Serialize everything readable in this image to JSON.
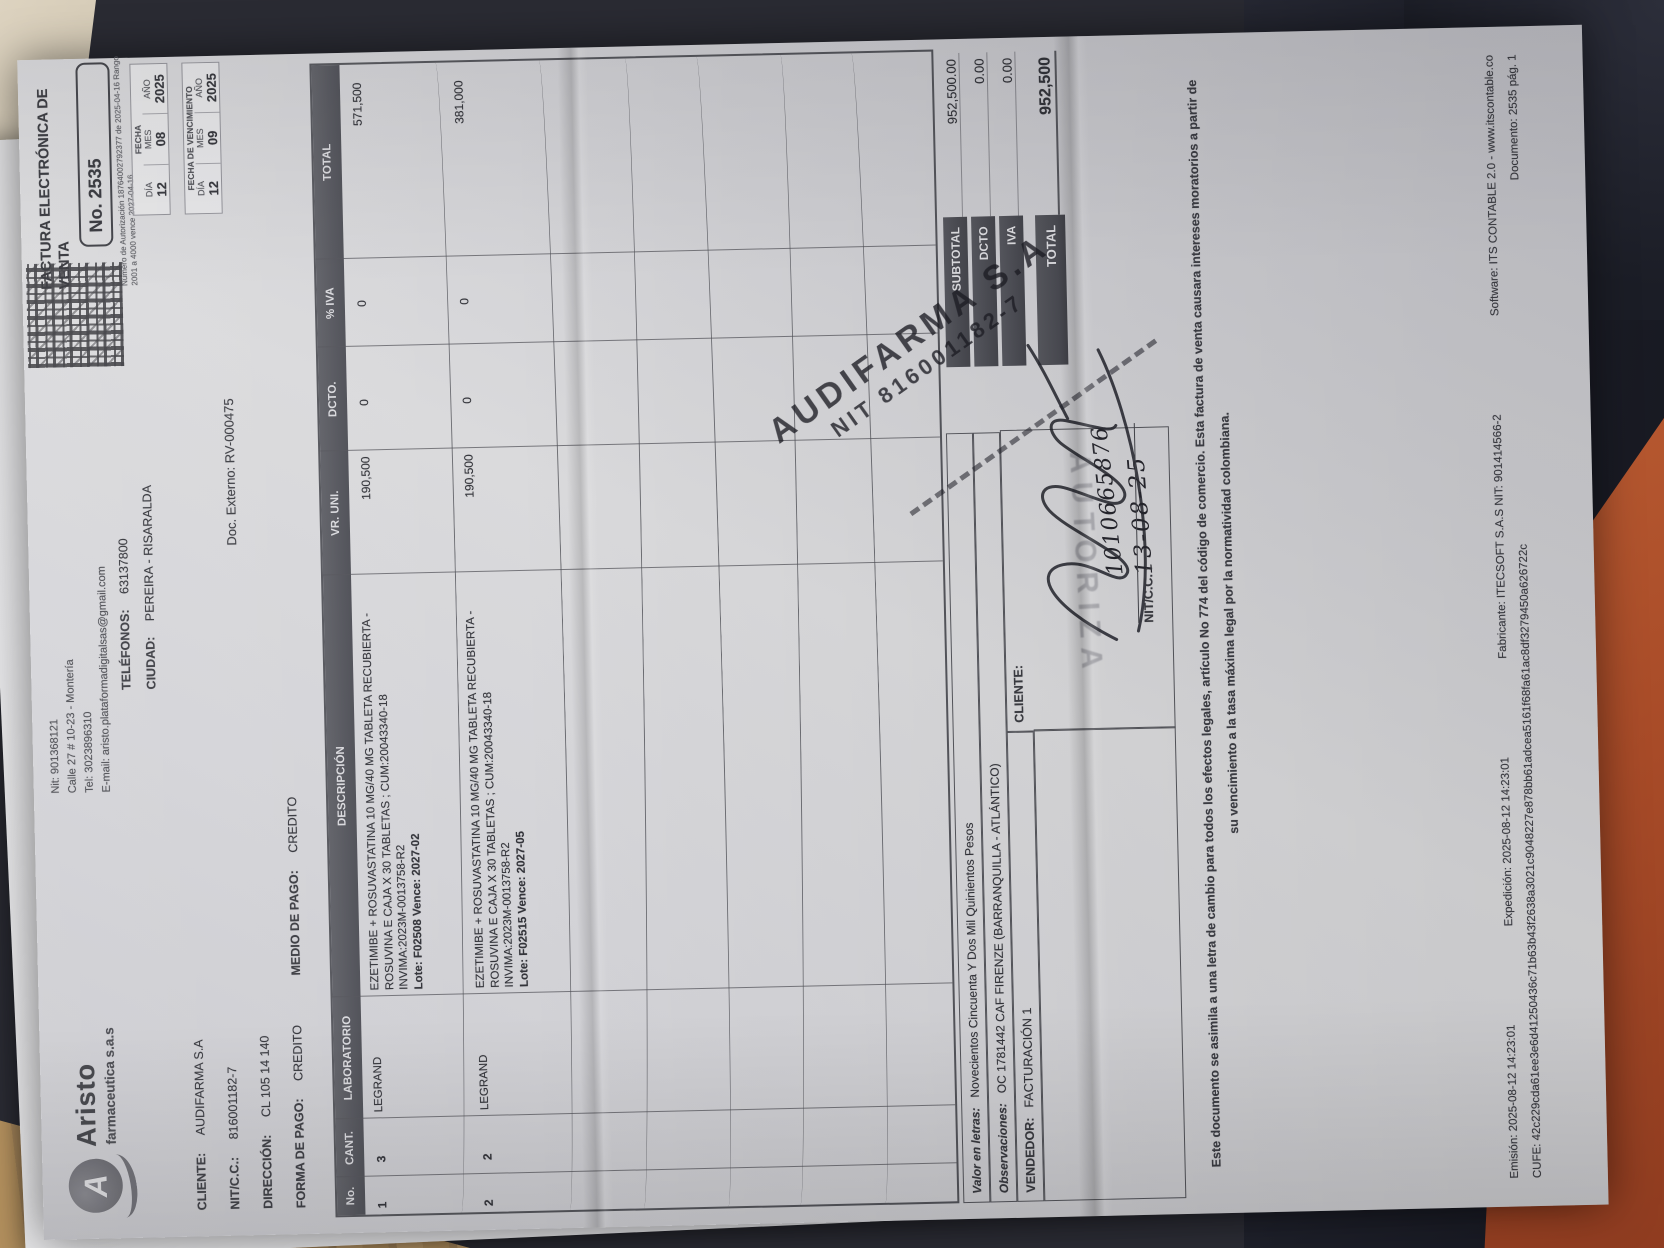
{
  "brand": {
    "logo_letter": "A",
    "name": "Aristo",
    "subname": "farmaceutica s.a.s"
  },
  "supplier": {
    "lines": [
      "Nit: 901368121",
      "Calle 27 # 10-23 - Montería",
      "Tel: 3023896310",
      "E-mail: aristo.plataformadigitalsas@gmail.com"
    ]
  },
  "header": {
    "doc_type": "FACTURA ELECTRÓNICA DE VENTA",
    "number": "No. 2535",
    "auth_line1": "Número de Autorización 18764002792377 de",
    "auth_line2": "2025-04-16 Rango 2001 a 4000 vence 2027-04-16",
    "doc_externo": "Doc. Externo: RV-000475"
  },
  "client": {
    "cliente_label": "CLIENTE:",
    "cliente": "AUDIFARMA S.A",
    "nit_label": "NIT/C.C.:",
    "nit": "816001182-7",
    "direccion_label": "DIRECCIÓN:",
    "direccion": "CL 105 14 140",
    "forma_label": "FORMA DE PAGO:",
    "forma": "CREDITO",
    "medio_label": "MEDIO DE PAGO:",
    "medio": "CREDITO",
    "tel_label": "TELÉFONOS:",
    "tel": "63137800",
    "ciudad_label": "CIUDAD:",
    "ciudad": "PEREIRA - RISARALDA"
  },
  "dates": {
    "fecha_title": "FECHA",
    "venc_title": "FECHA DE VENCIMIENTO",
    "dia_label": "DÍA",
    "mes_label": "MES",
    "ano_label": "AÑO",
    "fecha": {
      "dia": "12",
      "mes": "08",
      "ano": "2025"
    },
    "venc": {
      "dia": "12",
      "mes": "09",
      "ano": "2025"
    }
  },
  "table": {
    "headers": {
      "no": "No.",
      "cant": "CANT.",
      "lab": "LABORATORIO",
      "desc": "DESCRIPCIÓN",
      "vruni": "VR. UNI.",
      "dcto": "DCTO.",
      "iva": "% IVA",
      "total": "TOTAL"
    },
    "items": [
      {
        "no": "1",
        "cant": "3",
        "lab": "LEGRAND",
        "desc1": "EZETIMIBE + ROSUVASTATINA 10 MG/40 MG TABLETA RECUBIERTA -",
        "desc2": "ROSUVINA E CAJA X 30 TABLETAS ; CUM:20043340-18",
        "desc3": "INVIMA:2023M-0013758-R2",
        "desc4": "Lote: F02508 Vence: 2027-02",
        "vruni": "190,500",
        "dcto": "0",
        "iva": "0",
        "total": "571,500"
      },
      {
        "no": "2",
        "cant": "2",
        "lab": "LEGRAND",
        "desc1": "EZETIMIBE + ROSUVASTATINA 10 MG/40 MG TABLETA RECUBIERTA -",
        "desc2": "ROSUVINA E CAJA X 30 TABLETAS ; CUM:20043340-18",
        "desc3": "INVIMA:2023M-0013758-R2",
        "desc4": "Lote: F02515 Vence: 2027-05",
        "vruni": "190,500",
        "dcto": "0",
        "iva": "0",
        "total": "381,000"
      }
    ]
  },
  "bottom": {
    "valor_label": "Valor en letras:",
    "valor": "Novecientos Cincuenta Y Dos Mil Quinientos Pesos",
    "obs_label": "Observaciones:",
    "obs": "OC 1781442 CAF FIRENZE (BARRANQUILLA - ATLÁNTICO)",
    "vendedor_label": "VENDEDOR:",
    "vendedor": "FACTURACIÓN 1",
    "cliente_label": "CLIENTE:",
    "nitcc_label": "NIT/C.C. :"
  },
  "totals": {
    "subtotal_label": "SUBTOTAL",
    "subtotal": "952,500.00",
    "dcto_label": "DCTO",
    "dcto": "0.00",
    "iva_label": "IVA",
    "iva": "0.00",
    "total_label": "TOTAL",
    "total": "952,500"
  },
  "stamps": {
    "autoriza": "AUTORIZA",
    "line1": "AUDIFARMA S.A",
    "line2": "NIT 816001182-7",
    "hand_number": "1010665876",
    "hand_date": "13-08-25"
  },
  "legal": {
    "line1": "Este documento se asimila a una letra de cambio para todos los efectos legales, artículo No 774 del código de comercio. Esta factura de venta causara intereses moratorios a partir de",
    "line2": "su vencimiento a la tasa máxima legal por la normatividad colombiana."
  },
  "footer": {
    "emision": "Emisión: 2025-08-12 14:23:01",
    "expedicion": "Expedición: 2025-08-12 14:23:01",
    "fabricante": "Fabricante: ITECSOFT S.A.S   NIT: 901414566-2",
    "software": "Software: ITS CONTABLE 2.0 - www.itscontable.co",
    "cufe": "CUFE: 42c229cda61ee3e6d41250436c71b63b43f2638a3021c9048227e878bb61adcea5161f68fa61ac8df3279450a626722c",
    "documento": "Documento: 2535 pág. 1"
  },
  "colors": {
    "navy_fabric": "#1d1f29",
    "orange_fabric": "#a84b28",
    "wood": "#b3905e",
    "paper": "#d4d4d8",
    "band_dark": "#4f5057"
  }
}
